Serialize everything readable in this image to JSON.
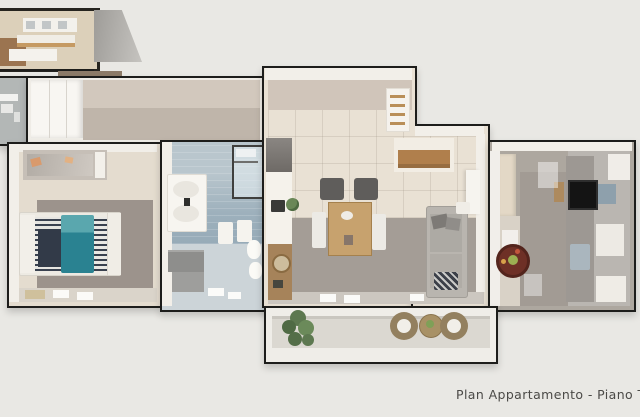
{
  "caption": {
    "text": "Plan Appartamento - Piano Terzo"
  },
  "scene": {
    "type": "3d-floor-plan-render",
    "rooms": [
      {
        "id": "neighbor-unit-inset",
        "items": [
          "kitchen-cabinets"
        ]
      },
      {
        "id": "hallway",
        "items": [
          "wardrobe-closet"
        ]
      },
      {
        "id": "utility-room",
        "items": [
          "shelf-fixtures"
        ]
      },
      {
        "id": "bedroom",
        "items": [
          "double-bed-teal",
          "dresser-with-mirror",
          "gray-rug",
          "doormat"
        ]
      },
      {
        "id": "bathroom",
        "items": [
          "shower",
          "sink-cabinet",
          "towels",
          "toilet",
          "bidet",
          "storage-boxes"
        ]
      },
      {
        "id": "living-dining",
        "items": [
          "fridge",
          "kitchen-counter",
          "wood-cabinet",
          "shelf-unit",
          "sideboard",
          "dining-table",
          "chairs",
          "sofa",
          "plant"
        ]
      },
      {
        "id": "study-room",
        "items": [
          "tv-wall-unit",
          "round-red-table",
          "cabinets",
          "doors"
        ]
      },
      {
        "id": "balcony",
        "items": [
          "green-plant",
          "rattan-chair",
          "round-side-table",
          "rattan-chair"
        ]
      }
    ]
  },
  "palette": {
    "background": "#e9e8e4",
    "wall_outline": "#1d1d1b",
    "wall_fill": "#f2efe9",
    "bed_teal": "#2a8291",
    "bathroom_tile": "#9db0bc",
    "wood": "#b07f4c",
    "floor_gray": "#a49d96",
    "floor_beige": "#e9e1d4",
    "plant_green": "#5f7a50",
    "caption_color": "#4b4a47"
  }
}
